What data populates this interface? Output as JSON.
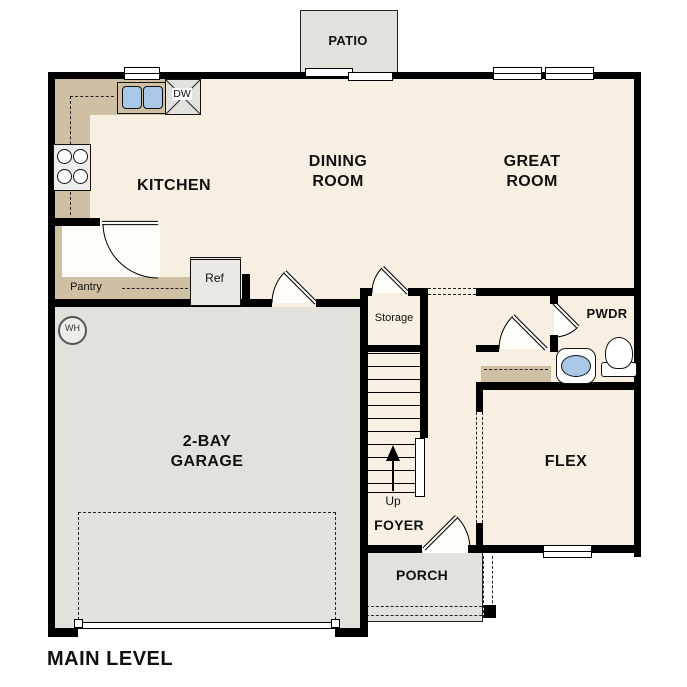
{
  "plan_title": "MAIN LEVEL",
  "rooms": {
    "patio": "PATIO",
    "kitchen": "KITCHEN",
    "dining_room": "DINING ROOM",
    "great_room": "GREAT ROOM",
    "garage": "2-BAY GARAGE",
    "flex": "FLEX",
    "foyer": "FOYER",
    "porch": "PORCH",
    "powder_room": "PWDR",
    "storage": "Storage",
    "pantry": "Pantry"
  },
  "labels": {
    "refrigerator": "Ref",
    "dishwasher": "DW",
    "water_heater": "WH",
    "stairs_up": "Up"
  },
  "colors": {
    "floor": "#f7f0e2",
    "hard_surface": "#e3e1dc",
    "cabinetry": "#cfc0a4",
    "fixture_blue": "#a9c7e6",
    "wall": "#000000"
  }
}
